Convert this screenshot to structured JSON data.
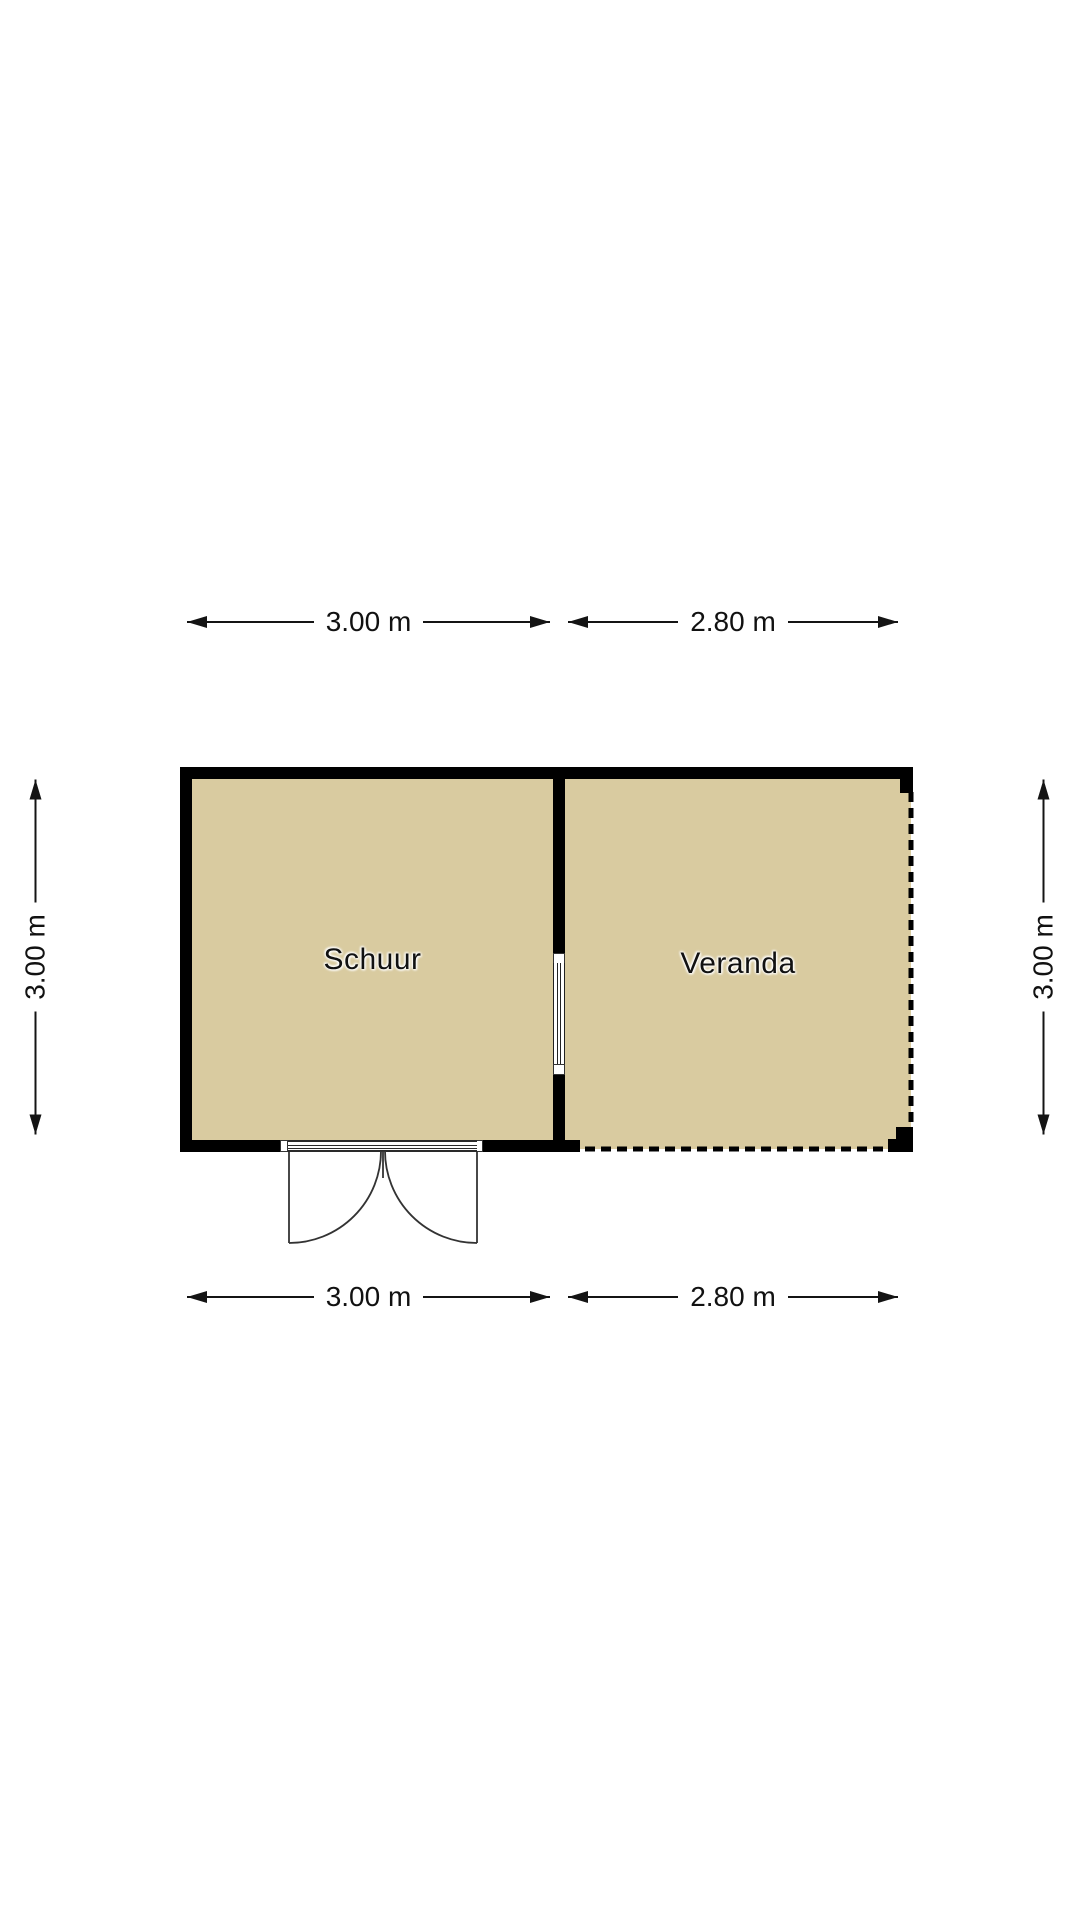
{
  "colors": {
    "background": "#ffffff",
    "floor": "#d9cba0",
    "wall": "#000000",
    "line": "#141414",
    "text": "#111111"
  },
  "floorplan": {
    "rooms": [
      {
        "label": "Schuur"
      },
      {
        "label": "Veranda"
      }
    ],
    "dimensions": {
      "top": [
        {
          "label": "3.00 m"
        },
        {
          "label": "2.80 m"
        }
      ],
      "bottom": [
        {
          "label": "3.00 m"
        },
        {
          "label": "2.80 m"
        }
      ],
      "left": {
        "label": "3.00 m"
      },
      "right": {
        "label": "3.00 m"
      }
    }
  }
}
